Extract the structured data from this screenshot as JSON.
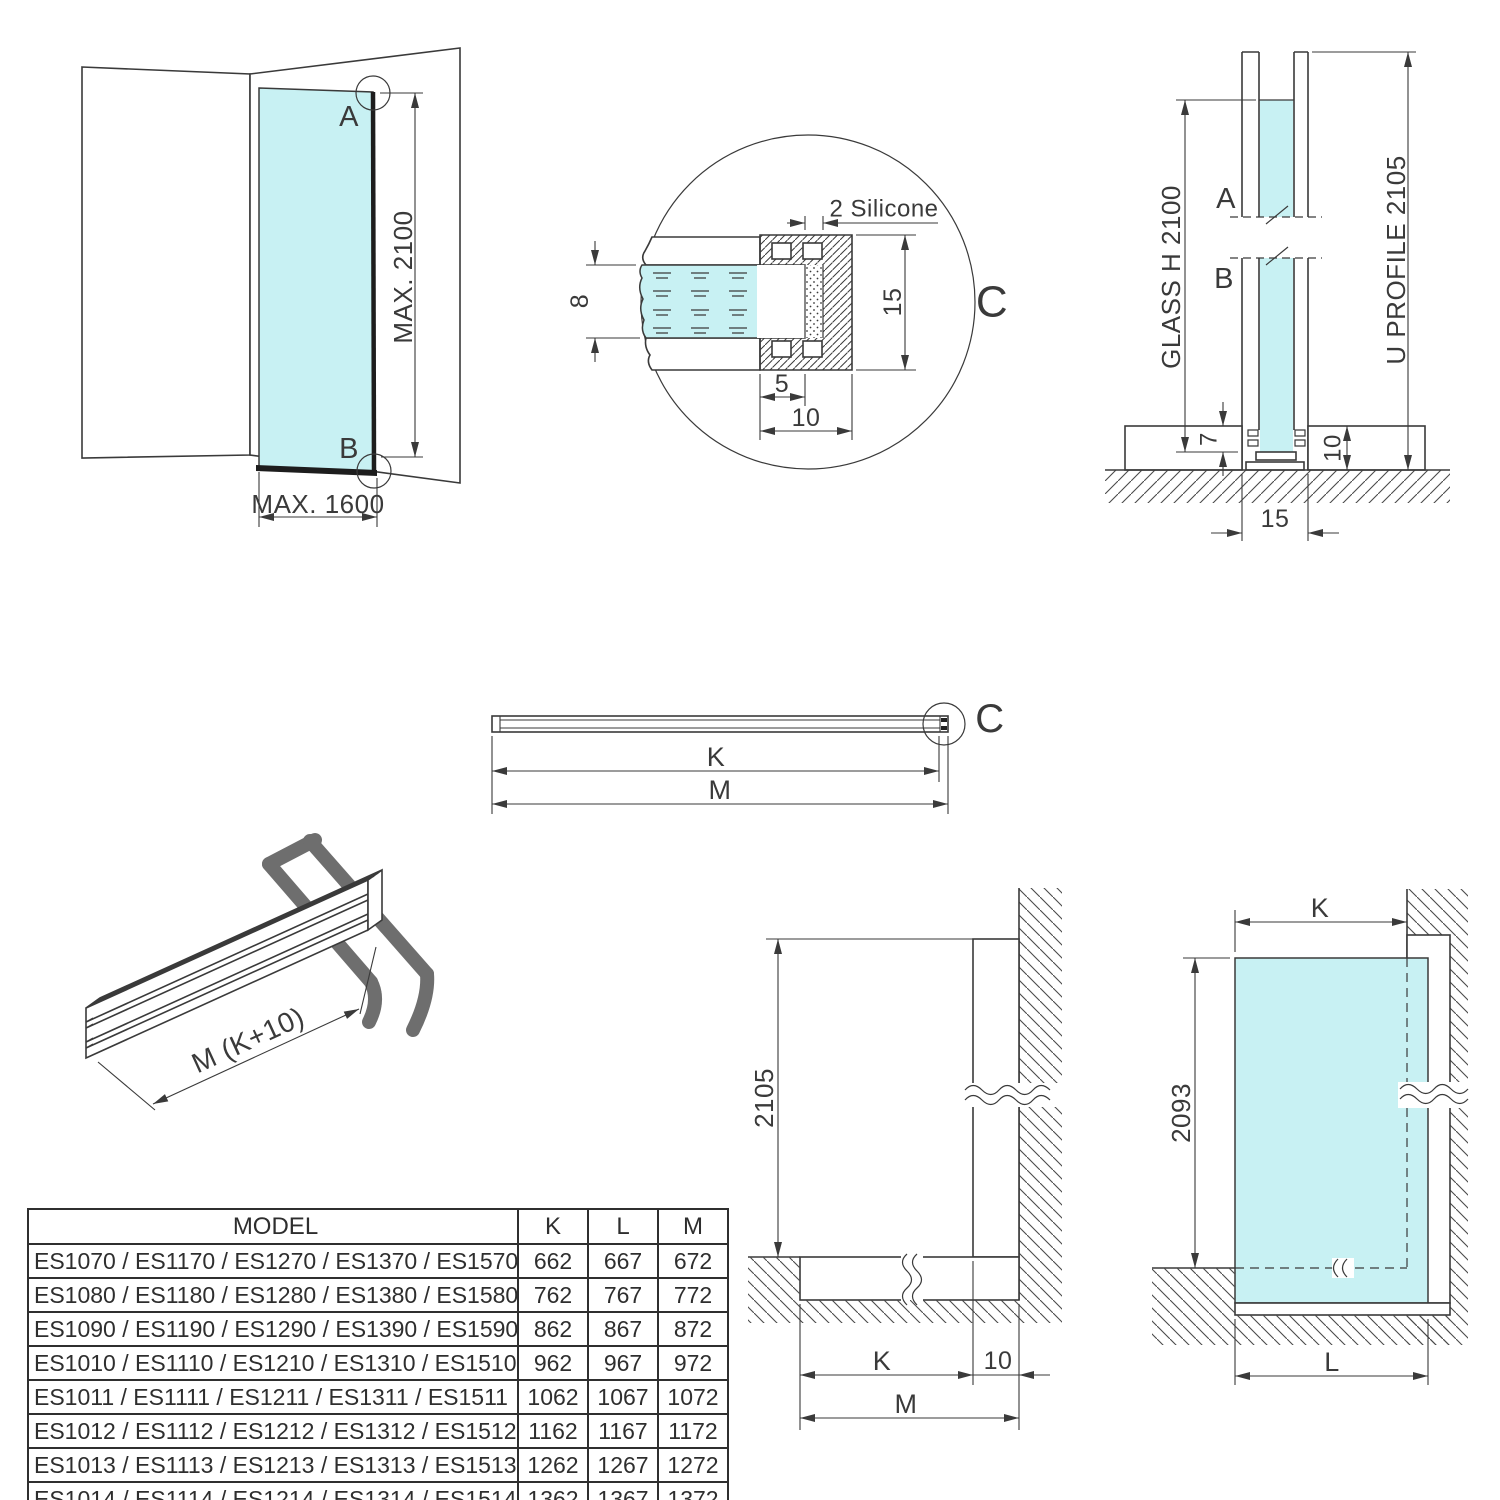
{
  "colors": {
    "glass": "#c8f1f3",
    "line": "#3a3a3a",
    "angle_profile_dark": "#6e6e6e"
  },
  "views": {
    "corner": {
      "a": "A",
      "b": "B",
      "max_h": "MAX. 2100",
      "max_w": "MAX. 1600"
    },
    "detail": {
      "c": "C",
      "silicone": "2 Silicone",
      "glass_thk": "8",
      "height": "15",
      "insert": "5",
      "depth": "10"
    },
    "section": {
      "a": "A",
      "b": "B",
      "glass": "GLASS H 2100",
      "profile": "U PROFILE 2105",
      "recess": "7",
      "floor": "10",
      "width": "15"
    },
    "bar": {
      "c": "C",
      "k": "K",
      "m": "M"
    },
    "iso": {
      "len": "M (K+10)"
    },
    "elev_profile": {
      "h": "2105",
      "k": "K",
      "ten": "10",
      "m": "M"
    },
    "elev_glass": {
      "h": "2093",
      "k": "K",
      "l": "L"
    }
  },
  "table": {
    "headers": [
      "MODEL",
      "K",
      "L",
      "M"
    ],
    "rows": [
      {
        "model": "ES1070 / ES1170 / ES1270 / ES1370 / ES1570",
        "k": "662",
        "l": "667",
        "m": "672"
      },
      {
        "model": "ES1080 / ES1180 / ES1280 / ES1380 / ES1580",
        "k": "762",
        "l": "767",
        "m": "772"
      },
      {
        "model": "ES1090 / ES1190 / ES1290 / ES1390 / ES1590",
        "k": "862",
        "l": "867",
        "m": "872"
      },
      {
        "model": "ES1010 / ES1110 / ES1210 / ES1310 / ES1510",
        "k": "962",
        "l": "967",
        "m": "972"
      },
      {
        "model": "ES1011 / ES1111 / ES1211 / ES1311 / ES1511",
        "k": "1062",
        "l": "1067",
        "m": "1072"
      },
      {
        "model": "ES1012 / ES1112 / ES1212 / ES1312 / ES1512",
        "k": "1162",
        "l": "1167",
        "m": "1172"
      },
      {
        "model": "ES1013 / ES1113 / ES1213 / ES1313 / ES1513",
        "k": "1262",
        "l": "1267",
        "m": "1272"
      },
      {
        "model": "ES1014 / ES1114 / ES1214 / ES1314 / ES1514",
        "k": "1362",
        "l": "1367",
        "m": "1372"
      }
    ]
  }
}
